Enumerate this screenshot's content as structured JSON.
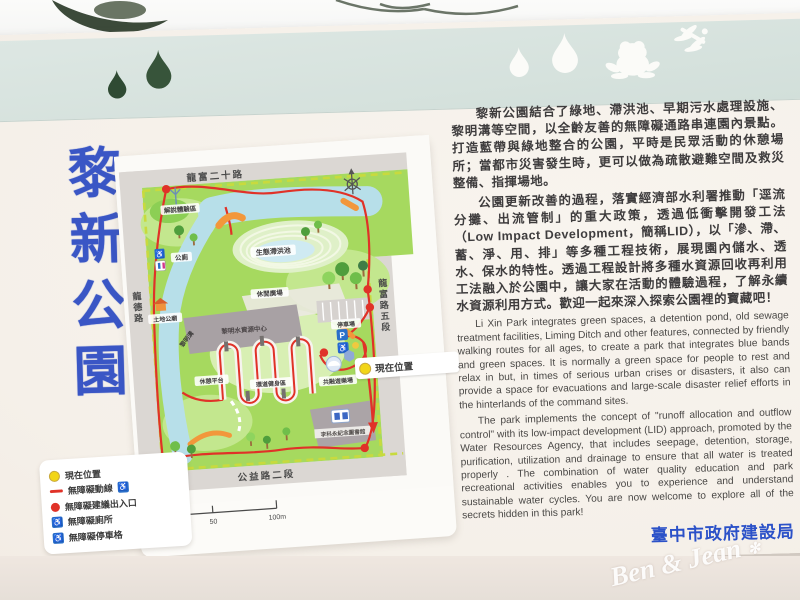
{
  "photo": {
    "watermark": "Ben & Jean",
    "watermark_star": "✻"
  },
  "board": {
    "title": "黎新公園",
    "agency": "臺中市政府建設局",
    "decor_icons": [
      "water-drop-foliage",
      "water-drop-foliage",
      "water-drop-white",
      "water-drop-white",
      "frog-white",
      "dragonfly-white"
    ]
  },
  "intro_zh": [
    "黎新公園結合了綠地、滯洪池、早期污水處理設施、黎明溝等空間，以全齡友善的無障礙通路串連園內景點。打造藍帶與綠地整合的公園，平時是民眾活動的休憩場所；當都市災害發生時，更可以做為疏散避難空間及救災整備、指揮場地。",
    "公園更新改善的過程，落實經濟部水利署推動「逕流分攤、出流管制」的重大政策，透過低衝擊開發工法（Low Impact Development，簡稱LID），以「滲、滯、蓄、淨、用、排」等多種工程技術，展現園內儲水、透水、保水的特性。透過工程設計將多種水資源回收再利用工法融入於公園中，讓大家在活動的體驗過程，了解永續水資源利用方式。歡迎一起來深入探索公園裡的寶藏吧！"
  ],
  "intro_en": [
    "Li Xin Park integrates green spaces, a detention pond, old sewage treatment facilities, Liming Ditch and other features, connected by friendly walking routes for all ages, to create a park that integrates blue bands and green spaces. It is normally a green space for people to rest and relax in but, in times of serious urban crises or disasters, it also can provide a space for evacuations and large-scale disaster relief efforts in the hinterlands of the command sites.",
    "The park implements the concept of \"runoff allocation and outflow control\" with its low-impact development (LID) approach, promoted by the Water Resources Agency, that includes seepage, detention, storage, purification, utilization and drainage to ensure that all water is treated properly . The combination of water quality education and park recreational activities enables you to experience and understand sustainable water cycles. You are now welcome to explore all of the secrets hidden in this park!"
  ],
  "map": {
    "road_top": "龍富二十路",
    "road_left": "龍德路",
    "road_right": "龍富路五段",
    "road_bottom": "公益路二段",
    "compass_label": "北",
    "poi": {
      "interpretive_area": "解說體驗區",
      "toilet": "公廁",
      "eco_pond": "生態滯洪池",
      "leisure_plaza": "休閒廣場",
      "water_center": "黎明水資源中心",
      "land_god_temple": "土地公廟",
      "liming_ditch": "黎明溝",
      "rest_platform": "休憩平台",
      "loop_fitness": "環道健身區",
      "parking": "停車場",
      "parking_p": "P",
      "inclusive_playground": "共融遊樂場",
      "library": "李科永紀念圖書館",
      "current_location": "現在位置"
    },
    "scale_ticks": [
      "0",
      "10",
      "20",
      "50",
      "100m"
    ]
  },
  "legend": {
    "items": [
      {
        "symbol": "yellow-circle",
        "label": "現在位置"
      },
      {
        "symbol": "red-line-wheelchair",
        "label": "無障礙動線"
      },
      {
        "symbol": "red-dot",
        "label": "無障礙建議出入口"
      },
      {
        "symbol": "wheelchair",
        "label": "無障礙廁所"
      },
      {
        "symbol": "wheelchair",
        "label": "無障礙停車格"
      }
    ]
  },
  "colors": {
    "title_blue": "#3a56c5",
    "agency_blue": "#2b51c8",
    "route_red": "#e03228",
    "map_green": "#a6d95f",
    "water_blue": "#b7dfe9",
    "band_green": "#d8e3df",
    "legend_yellow": "#f2d517",
    "accessible_blue": "#2a6fc9"
  }
}
